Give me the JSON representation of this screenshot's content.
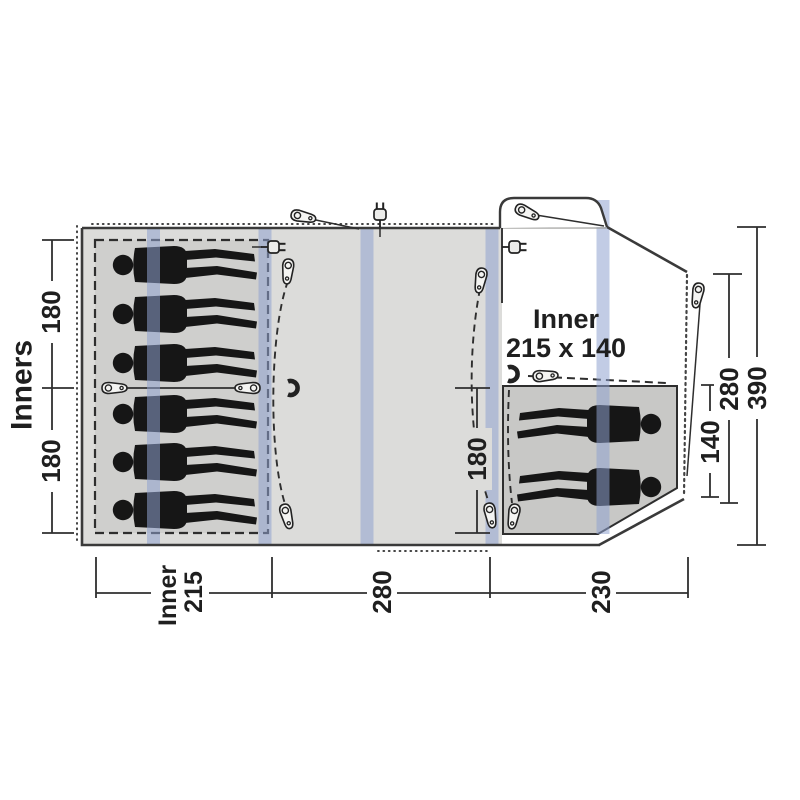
{
  "diagram": {
    "type": "tent-floorplan-top-view",
    "side_label": "Inners",
    "inner_title": {
      "line1": "Inner",
      "line2": "215 x 140"
    },
    "dimensions": {
      "left_top": "180",
      "left_bottom": "180",
      "living_depth": "180",
      "porch_inner_width": "140",
      "porch_depth": "280",
      "total_depth": "390",
      "bottom_inner": {
        "line1": "Inner",
        "line2": "215"
      },
      "bottom_living": "280",
      "bottom_porch": "230"
    },
    "figures": {
      "left_inner_count": 6,
      "right_inner_count": 2
    },
    "icons": [
      "zipper-pull-icon",
      "power-inlet-icon",
      "magnet-clip-icon",
      "guy-line"
    ],
    "colors": {
      "tent_fill": "#dcdcda",
      "inner_left_fill": "#cfcfcd",
      "inner_right_fill": "#c8c8c6",
      "air_tube": "#8fa3cf",
      "figure": "#161616",
      "line": "#333333"
    }
  }
}
